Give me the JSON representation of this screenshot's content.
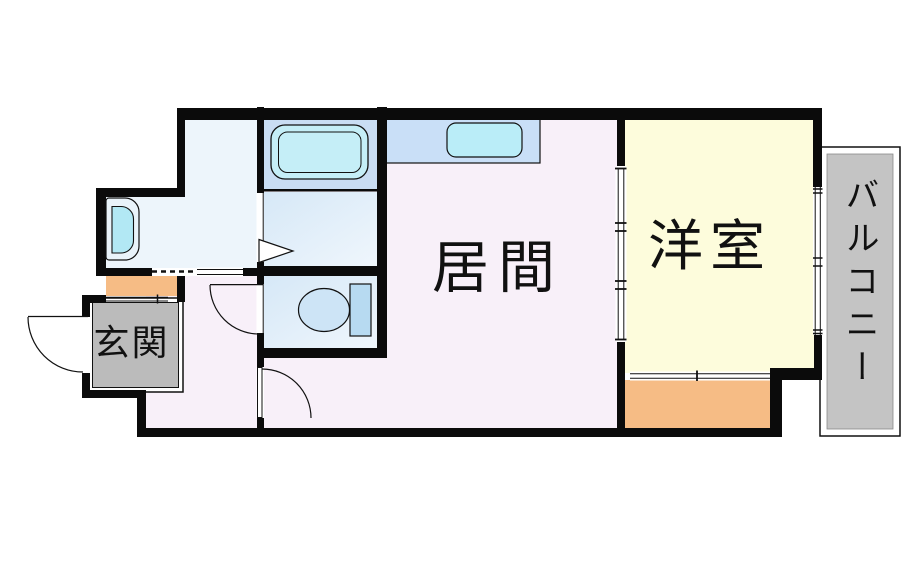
{
  "plan": {
    "type": "apartment-floor-plan",
    "rooms": {
      "living": {
        "label": "居間"
      },
      "western": {
        "label": "洋室"
      },
      "entrance": {
        "label": "玄関"
      },
      "balcony": {
        "label": "バルコニー"
      }
    },
    "fixtures": [
      "bathtub",
      "kitchen-sink",
      "vanity-basin",
      "toilet"
    ]
  },
  "palette": {
    "wall": "#0b0b0b",
    "living_floor": "#f8f0f9",
    "western_floor": "#fdfcdc",
    "washroom_floor": "#edf5fb",
    "bath_floor": "#c9ddf3",
    "wet_floor_dark": "#d6e8f7",
    "wet_floor_light": "#eff6fc",
    "bathtub": "#c5eef7",
    "bathtub_room_divider": "#111111",
    "kitchen_counter": "#c9dff7",
    "kitchen_sink": "#baedf8",
    "vanity_body": "#e9f3fa",
    "vanity_basin": "#b2e8f4",
    "toilet_bowl": "#cde4f6",
    "toilet_tank": "#b7daf1",
    "step_orange": "#f6bc85",
    "storage_orange": "#f6bc85",
    "entrance_gray": "#bbbbbb",
    "balcony_gray": "#c4c4c4",
    "text": "#111111"
  }
}
